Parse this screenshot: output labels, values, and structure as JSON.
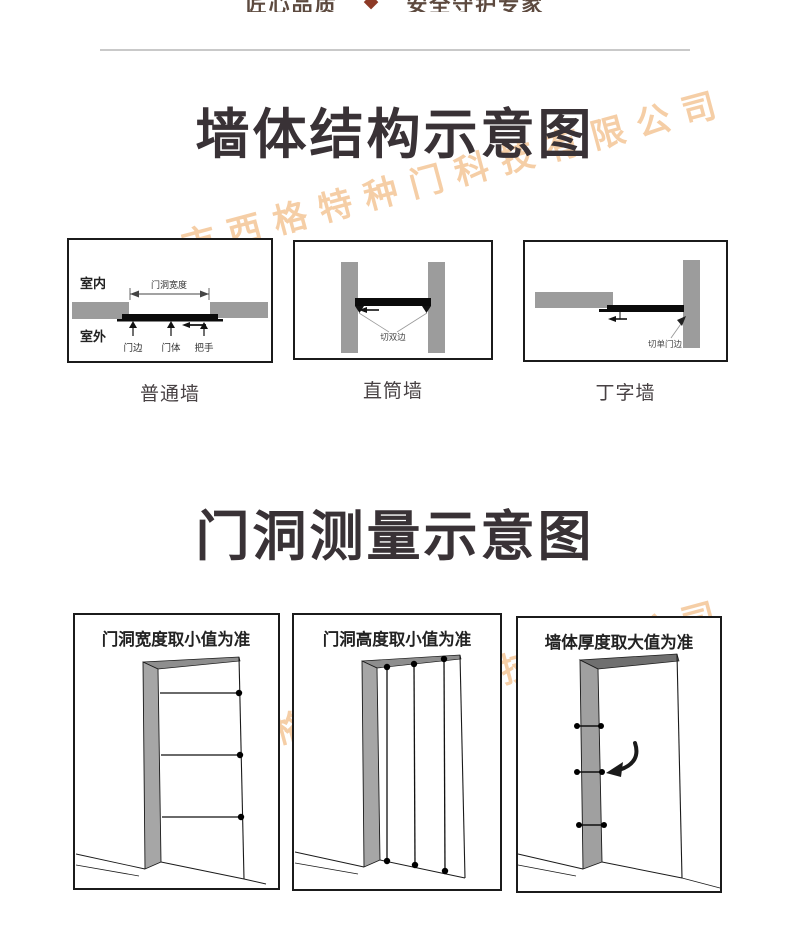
{
  "page": {
    "watermark_text": "佛山市西格特种门科技有限公司",
    "watermark_color": "#f5c99d"
  },
  "header": {
    "left_text": "匠心品质",
    "right_text": "安全守护专家"
  },
  "wall_section": {
    "title": "墙体结构示意图",
    "normal": {
      "caption": "普通墙",
      "indoor": "室内",
      "outdoor": "室外",
      "width_dim": "门洞宽度",
      "door_edge": "门边",
      "door_body": "门体",
      "handle": "把手"
    },
    "straight": {
      "caption": "直筒墙",
      "cut": "切双边"
    },
    "tee": {
      "caption": "丁字墙",
      "cut": "切单门边"
    }
  },
  "measure_section": {
    "title": "门洞测量示意图",
    "width": {
      "caption": "门洞宽度取小值为准"
    },
    "height": {
      "caption": "门洞高度取小值为准"
    },
    "thickness": {
      "caption": "墙体厚度取大值为准"
    }
  },
  "colors": {
    "title": "#393236",
    "wall_gray": "#9c9c9c",
    "door_black": "#0b0b0b",
    "jamb_gray": "#a6a6a6",
    "divider": "#c9c9c9"
  }
}
